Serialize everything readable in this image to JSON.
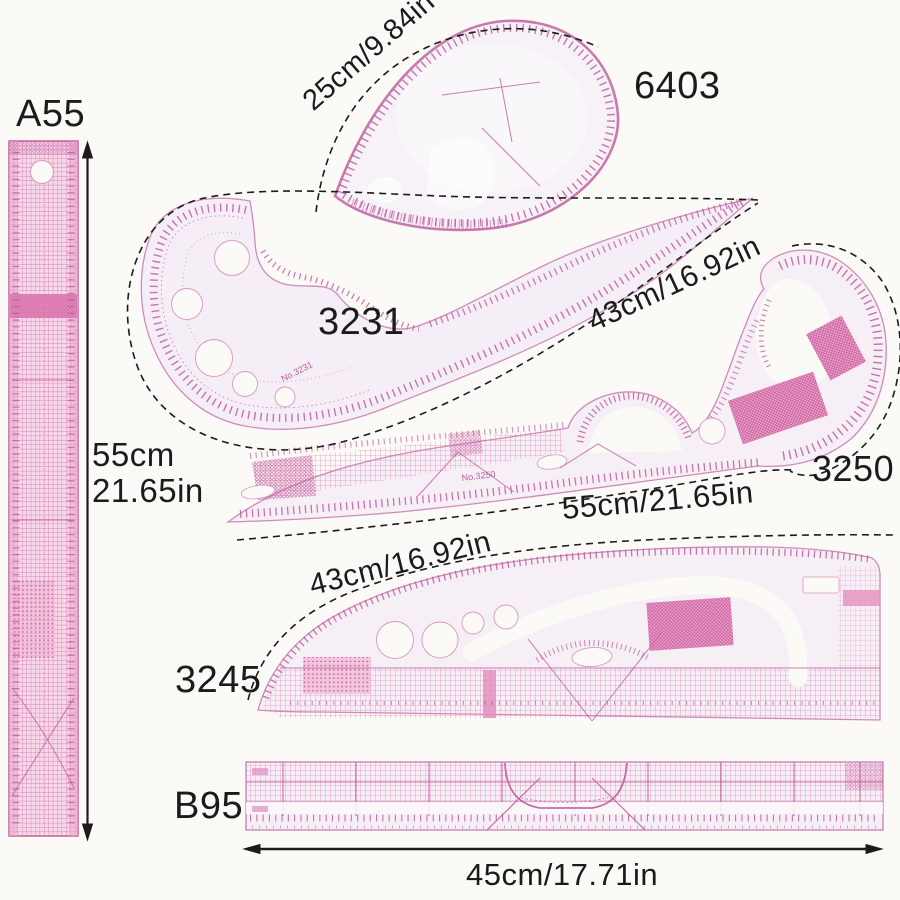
{
  "items": {
    "a55": {
      "code": "A55",
      "size_cm": "55cm",
      "size_in": "21.65in"
    },
    "c6403": {
      "code": "6403",
      "size": "25cm/9.84in"
    },
    "c3231": {
      "code": "3231",
      "size": "43cm/16.92in",
      "engraving": "No.3231"
    },
    "c3250": {
      "code": "3250",
      "size": "55cm/21.65in",
      "engraving": "No.3250"
    },
    "c3245": {
      "code": "3245",
      "size": "43cm/16.92in"
    },
    "b95": {
      "code": "B95",
      "size": "45cm/17.71in"
    }
  },
  "colors": {
    "background": "#fcfaf7",
    "plastic": "#f5eef5",
    "plastic_pink": "#f6d9e9",
    "marking_pink": "#c0599c",
    "dense_pink": "#d672a8",
    "annotation": "#1b1b1b"
  }
}
